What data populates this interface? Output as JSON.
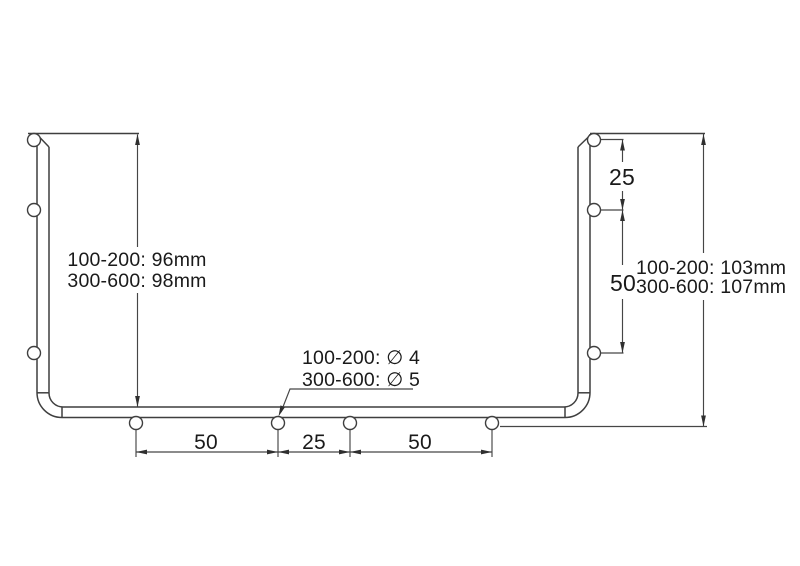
{
  "annotations": {
    "left_height": {
      "line1": "100-200: 96mm",
      "line2": "300-600: 98mm"
    },
    "right_height": {
      "line1": "100-200: 103mm",
      "line2": "300-600: 107mm"
    },
    "hole_diameter": {
      "line1": "100-200: ∅ 4",
      "line2": "300-600: ∅ 5"
    },
    "right_hole_spacing": {
      "between_top_holes": "25",
      "between_bottom_holes": "50"
    },
    "bottom_hole_spacing": {
      "left": "50",
      "middle": "25",
      "right": "50"
    }
  },
  "colors": {
    "line": "#3f3f3f",
    "dimension_line": "#464646",
    "text": "#1a1a1a",
    "background": "#ffffff"
  }
}
